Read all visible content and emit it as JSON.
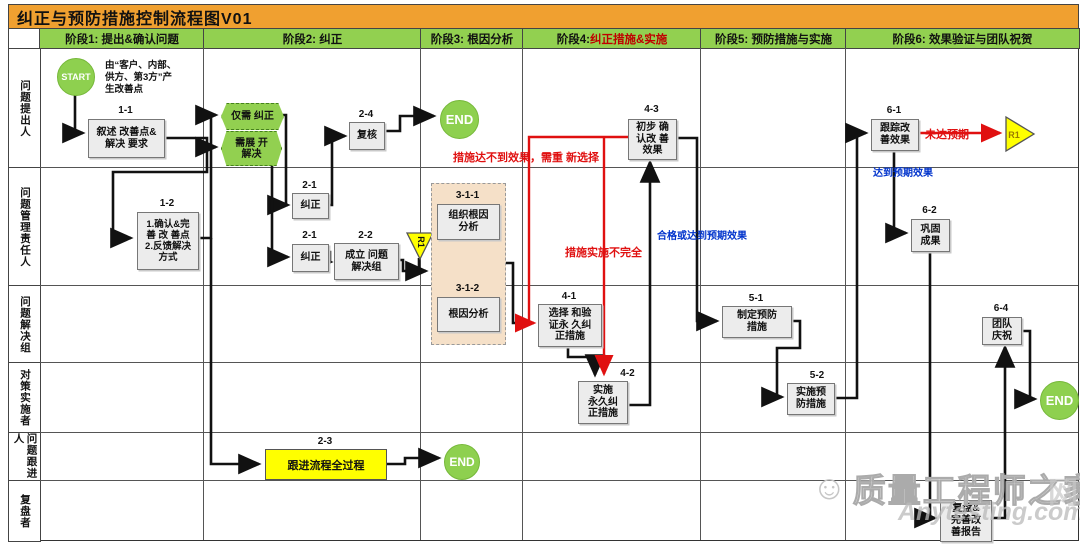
{
  "title": "纠正与预防措施控制流程图V01",
  "phases": [
    {
      "label": "阶段1: 提出&确认问题"
    },
    {
      "label": "阶段2: 纠正"
    },
    {
      "label": "阶段3: 根因分析"
    },
    {
      "label": "阶段4: ",
      "label_red": "纠正措施&实施"
    },
    {
      "label": "阶段5: 预防措施与实施"
    },
    {
      "label": "阶段6: 效果验证与团队祝贺"
    }
  ],
  "lanes": [
    {
      "label": "问题提出人"
    },
    {
      "label": "问题管理责任人"
    },
    {
      "label": "问题解决组"
    },
    {
      "label": "对策实施者"
    },
    {
      "label": "问题跟进人"
    },
    {
      "label": "复盘者"
    }
  ],
  "terminals": {
    "start": "START",
    "end1": "END",
    "end2": "END",
    "end3": "END"
  },
  "connectors": {
    "r1_down": "R1",
    "r1_right": "R1"
  },
  "nodes": {
    "n11": {
      "num": "1-1",
      "text": "叙述 改善点&\n解决 要求"
    },
    "n12": {
      "num": "1-2",
      "text": "1.确认&完\n善 改 善点\n2.反馈解决\n方式"
    },
    "hexOnly": {
      "text": "仅需 纠正"
    },
    "hexExpand": {
      "text": "需展 开\n解决"
    },
    "n21a": {
      "num": "2-1",
      "text": "纠正"
    },
    "n21b": {
      "num": "2-1",
      "text": "纠正"
    },
    "n22": {
      "num": "2-2",
      "text": "成立 问题\n解决组"
    },
    "n23": {
      "num": "2-3",
      "text": "跟进流程全过程"
    },
    "n24": {
      "num": "2-4",
      "text": "复核"
    },
    "n311": {
      "num": "3-1-1",
      "text": "组织根因\n分析"
    },
    "n312": {
      "num": "3-1-2",
      "text": "根因分析"
    },
    "n41": {
      "num": "4-1",
      "text": "选择 和验\n证永 久纠\n正措施"
    },
    "n42": {
      "num": "4-2",
      "text": "实施\n永久纠\n正措施"
    },
    "n43": {
      "num": "4-3",
      "text": "初步 确\n认改 善\n效果"
    },
    "n51": {
      "num": "5-1",
      "text": "制定预防\n措施"
    },
    "n52": {
      "num": "5-2",
      "text": "实施预\n防措施"
    },
    "n61": {
      "num": "6-1",
      "text": "跟踪改\n善效果"
    },
    "n62": {
      "num": "6-2",
      "text": "巩固\n成果"
    },
    "n64": {
      "num": "6-4",
      "text": "团队\n庆祝"
    },
    "n63": {
      "text": "复盘&\n完善改\n善报告"
    }
  },
  "annotations": {
    "start_note": "由“客户、内部、\n供方、第3方”产\n生改善点",
    "red_reselect": "措施达不到效果，需重 新选择",
    "red_incomplete": "措施实施不完全",
    "red_notmet": "未达预期",
    "blue_ok": "合格或达到预期效果",
    "blue_met": "达到预期效果"
  },
  "watermark": {
    "brand": "质量工程师之家",
    "face": "☺",
    "site": "Anytesting.com",
    "net": "网"
  },
  "colors": {
    "title_bg": "#f0a030",
    "phase_bg": "#92d050",
    "node_bg": "#ececec",
    "highlight_yellow": "#ffff00",
    "rootcause_bg": "#f5e0c8",
    "red": "#e01010",
    "blue": "#0033cc",
    "green_terminal": "#8ed04f"
  }
}
